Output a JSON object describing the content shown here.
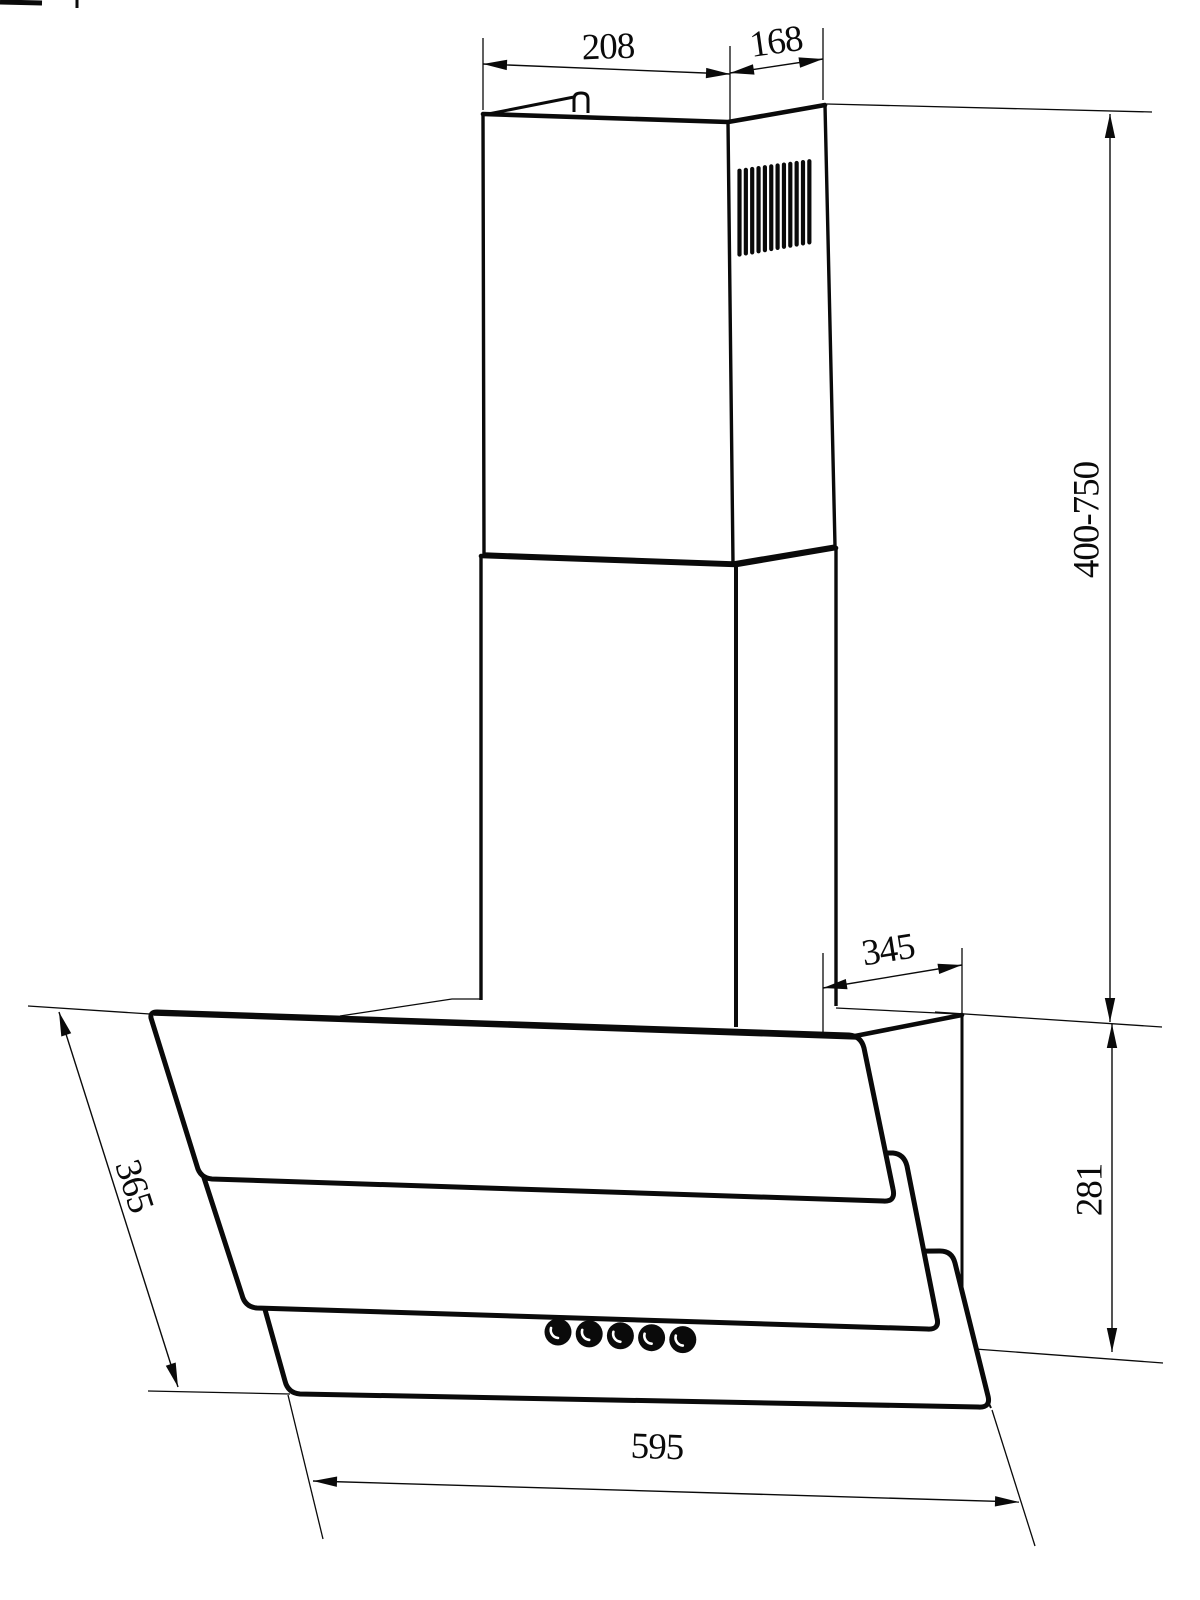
{
  "drawing": {
    "background_color": "#ffffff",
    "line_color": "#0a0a0a",
    "subject": "wall-mounted-angled-cooker-hood-dimension-drawing",
    "labels": {
      "chimney_width": "208",
      "chimney_depth": "168",
      "chimney_height_range": "400-750",
      "top_depth": "345",
      "body_height": "281",
      "panel_length": "365",
      "body_width": "595"
    },
    "features": {
      "vent_grille_slats": 12,
      "control_buttons": 5
    }
  }
}
